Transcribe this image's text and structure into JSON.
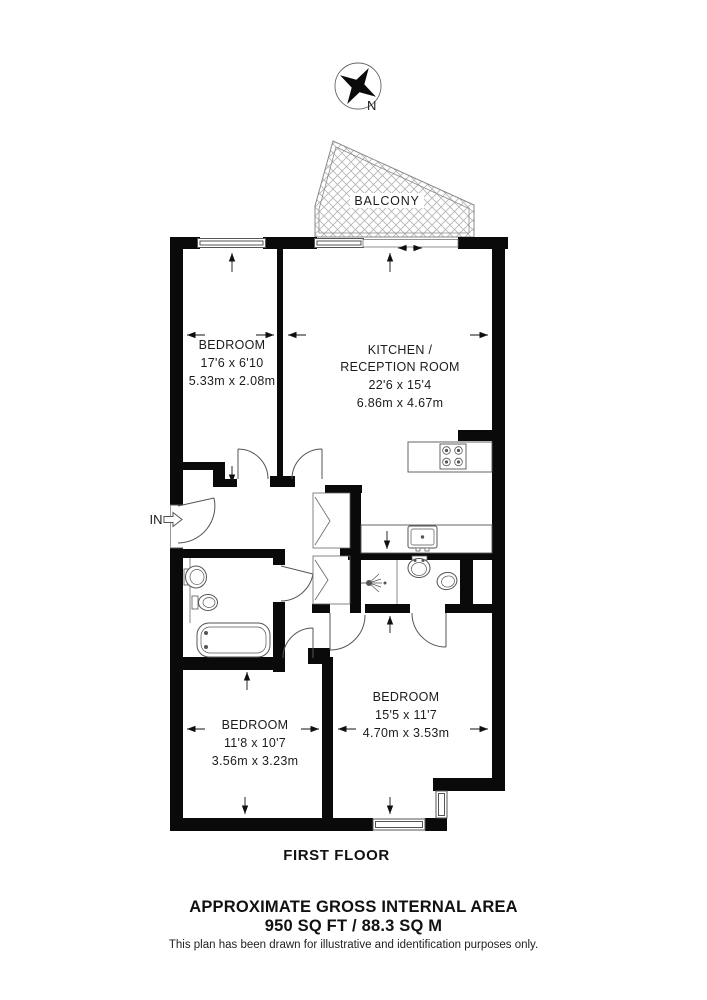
{
  "compass": {
    "north_label": "N"
  },
  "balcony": {
    "label": "BALCONY"
  },
  "entrance": {
    "label": "IN"
  },
  "rooms": {
    "bedroom_top": {
      "name": "BEDROOM",
      "imperial": "17'6 x 6'10",
      "metric": "5.33m x 2.08m"
    },
    "kitchen_reception": {
      "name_line1": "KITCHEN /",
      "name_line2": "RECEPTION ROOM",
      "imperial": "22'6 x 15'4",
      "metric": "6.86m x 4.67m"
    },
    "bedroom_bottom_left": {
      "name": "BEDROOM",
      "imperial": "11'8 x 10'7",
      "metric": "3.56m x 3.23m"
    },
    "bedroom_bottom_right": {
      "name": "BEDROOM",
      "imperial": "15'5 x 11'7",
      "metric": "4.70m x 3.53m"
    }
  },
  "footer": {
    "floor_label": "FIRST FLOOR",
    "area_title": "APPROXIMATE GROSS INTERNAL AREA",
    "area_value": "950 SQ FT / 88.3 SQ M",
    "disclaimer": "This plan has been drawn for illustrative and identification purposes only."
  },
  "colors": {
    "wall": "#0a0a0a",
    "line": "#555555",
    "hatch": "#b3b3b3",
    "text": "#1c1c1c",
    "background": "#ffffff"
  }
}
